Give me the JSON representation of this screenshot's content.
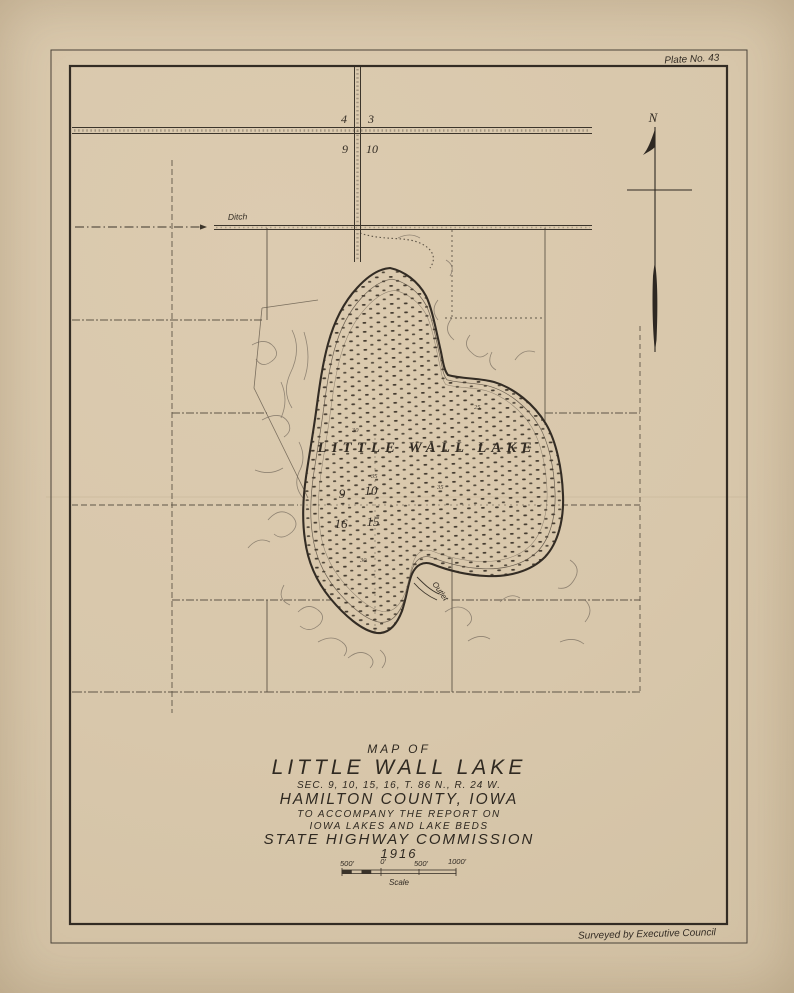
{
  "page": {
    "plate_label": "Plate No. 43",
    "credit": "Surveyed by Executive Council"
  },
  "compass": {
    "north": "N"
  },
  "map_labels": {
    "lake_name": "LITTLE WALL LAKE",
    "ditch": "Ditch",
    "outlet": "Outlet"
  },
  "section_numbers": {
    "road_nw": "4",
    "road_ne": "3",
    "road_sw": "9",
    "road_se": "10",
    "lake_nw": "9",
    "lake_ne": "10",
    "lake_sw": "16",
    "lake_se": "15"
  },
  "depth_labels": [
    "30",
    "35",
    "25",
    "35",
    "30"
  ],
  "title_block": {
    "map_of": "MAP OF",
    "lake_name": "LITTLE WALL LAKE",
    "sections": "SEC. 9, 10, 15, 16, T. 86 N., R. 24 W.",
    "county": "HAMILTON COUNTY, IOWA",
    "accompany": "TO ACCOMPANY THE REPORT ON",
    "report": "IOWA LAKES AND LAKE BEDS",
    "agency": "STATE HIGHWAY COMMISSION",
    "year": "1916"
  },
  "scale_bar": {
    "ticks": [
      "500'",
      "0'",
      "500'",
      "1000'"
    ],
    "caption": "Scale"
  },
  "colors": {
    "paper": "#d8c7ab",
    "ink": "#3a332a",
    "contour": "#70665a",
    "needle": "#2e2822"
  }
}
